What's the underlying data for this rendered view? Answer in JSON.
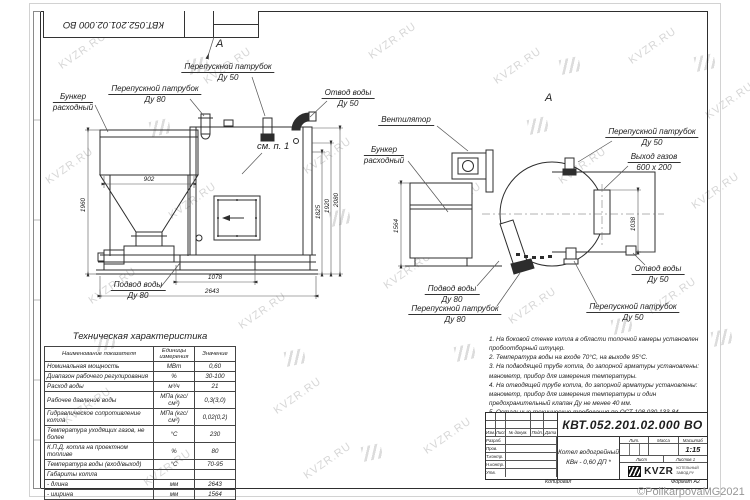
{
  "sheet": {
    "top_stamp": "КВТ.052.201.02.000 ВО",
    "watermark": "KVZR.RU",
    "copyright": "©PolikarpovaMG2021"
  },
  "front_view": {
    "view_mark": "А",
    "see_note": "см. п. 1",
    "callouts": {
      "bunker1": "Бункер",
      "bunker2": "расходный",
      "bypass80_1": "Перепускной патрубок",
      "bypass80_2": "Ду 80",
      "bypass50_1": "Перепускной патрубок",
      "bypass50_2": "Ду 50",
      "water_out1": "Отвод воды",
      "water_out2": "Ду 50",
      "water_in1": "Подвод воды",
      "water_in2": "Ду 80"
    },
    "dims": {
      "hopper_width": "902",
      "height": "1960",
      "h1": "1825",
      "h2": "1920",
      "h3": "2080",
      "w1": "1078",
      "length": "2643"
    }
  },
  "side_view": {
    "view_mark": "А",
    "callouts": {
      "fan": "Вентилятор",
      "bunker1": "Бункер",
      "bunker2": "расходный",
      "bypass50_top1": "Перепускной патрубок",
      "bypass50_top2": "Ду 50",
      "gas_out1": "Выход газов",
      "gas_out2": "600 х 200",
      "water_out1": "Отвод воды",
      "water_out2": "Ду 50",
      "water_in1": "Подвод воды",
      "water_in2": "Ду 80",
      "bypass80_1": "Перепускной патрубок",
      "bypass80_2": "Ду 80",
      "bypass50_bot1": "Перепускной патрубок",
      "bypass50_bot2": "Ду 50"
    },
    "dims": {
      "width": "1564",
      "gas_height": "1038"
    }
  },
  "spec_table": {
    "title": "Техническая характеристика",
    "headers": [
      "Наименование показателя",
      "Единицы измерения",
      "Значение"
    ],
    "rows": [
      [
        "Номинальная мощность",
        "МВт",
        "0,60"
      ],
      [
        "Диапазон рабочего регулирования",
        "%",
        "30-100"
      ],
      [
        "Расход воды",
        "м³/ч",
        "21"
      ],
      [
        "Рабочее давление воды",
        "МПа (кгс/см²)",
        "0,3(3,0)"
      ],
      [
        "Гидравлическое сопротивление котла",
        "МПа (кгс/см²)",
        "0,02(0,2)"
      ],
      [
        "Температура уходящих газов, не более",
        "°С",
        "230"
      ],
      [
        "К.П.Д. котла на проектном топливе",
        "%",
        "80"
      ],
      [
        "Температура воды (вход/выход)",
        "°С",
        "70-95"
      ],
      [
        "Габариты котла",
        "",
        ""
      ],
      [
        "- длина",
        "мм",
        "2643"
      ],
      [
        "- ширина",
        "мм",
        "1564"
      ],
      [
        "- высота",
        "мм",
        "2080"
      ]
    ]
  },
  "notes": {
    "items": [
      "1. На боковой стенке котла в области топочной камеры установлен пробоотборный штуцер.",
      "2. Температура воды на входе 70°С, на выходе 95°С.",
      "3. На подводящей трубе котла, до запорной арматуры установлены: манометр, прибор для измерения температуры.",
      "4. На отводящей трубе котла, до запорной арматуры установлены: манометр, прибор для измерения температуры и один предохранительный клапан Ду не менее 40 мм.",
      "5. Остальные технические требования по ОСТ 108.030.133-84."
    ],
    "footnote": "* Вид топлива: древесные отходы пеллетированные."
  },
  "title_block": {
    "doc_number": "КВТ.052.201.02.000 ВО",
    "name1": "Котел водогрейный",
    "name2": "КВн - 0,60   ДП *",
    "lit": "Лит.",
    "mass": "Масса",
    "scale": "Масштаб",
    "scale_value": "1:15",
    "sheet": "Лист",
    "sheets": "Листов 1",
    "logo": "KVZR",
    "logo_sub1": "КОТЕЛЬНЫЙ",
    "logo_sub2": "ЗАВОД.РУ",
    "kopiroval": "Копировал",
    "format": "Формат А2",
    "header_cols": [
      "Изм.",
      "Лист",
      "№ докум.",
      "Подп.",
      "Дата"
    ],
    "sig_rows": [
      "Разраб.",
      "Пров.",
      "Т.контр.",
      "Н.контр.",
      "Утв."
    ]
  }
}
